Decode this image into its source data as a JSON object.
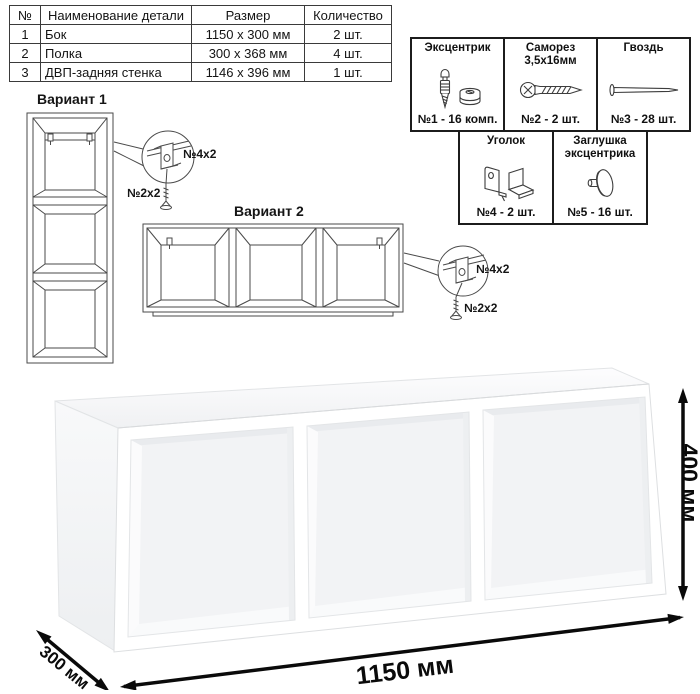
{
  "colors": {
    "background": "#ffffff",
    "table_border": "#3a3a3a",
    "drawing_line": "#4a4a4a",
    "dimension_color": "#0a0a0a"
  },
  "parts_table": {
    "headers": [
      "№",
      "Наименование детали",
      "Размер",
      "Количество"
    ],
    "rows": [
      [
        "1",
        "Бок",
        "1150 x 300 мм",
        "2 шт."
      ],
      [
        "2",
        "Полка",
        "300 x 368 мм",
        "4 шт."
      ],
      [
        "3",
        "ДВП-задняя стенка",
        "1146 x 396 мм",
        "1 шт."
      ]
    ]
  },
  "hardware": {
    "items": [
      {
        "name": "Эксцентрик",
        "qty": "№1 - 16 комп.",
        "icon": "eccentric-icon"
      },
      {
        "name": "Саморез 3,5х16мм",
        "qty": "№2 - 2 шт.",
        "icon": "screw-icon"
      },
      {
        "name": "Гвоздь",
        "qty": "№3 - 28 шт.",
        "icon": "nail-icon"
      },
      {
        "name": "Уголок",
        "qty": "№4 - 2 шт.",
        "icon": "corner-bracket-icon"
      },
      {
        "name": "Заглушка эксцентрика",
        "qty": "№5 - 16 шт.",
        "icon": "eccentric-cap-icon"
      }
    ]
  },
  "variant1": {
    "title": "Вариант 1",
    "bracket_label": "№4x2",
    "screw_label": "№2x2"
  },
  "variant2": {
    "title": "Вариант 2",
    "bracket_label": "№4x2",
    "screw_label": "№2x2"
  },
  "dimensions": {
    "width": "1150 мм",
    "height": "400 мм",
    "depth": "300 мм"
  }
}
